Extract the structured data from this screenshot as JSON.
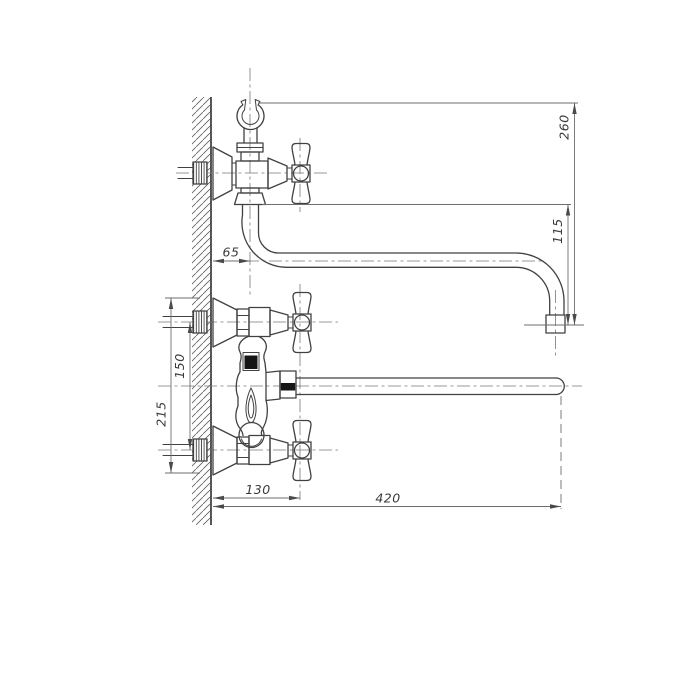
{
  "drawing": {
    "subject": "wall-mounted bathtub mixer faucet, side view technical drawing",
    "background_color": "#ffffff",
    "line_color": "#414141",
    "thin_line_color": "#6e6e6e",
    "dimensions": {
      "wall_to_spout_axis": "65",
      "wall_to_handle_axis": "130",
      "spout_reach": "420",
      "inlet_spacing": "150",
      "overall_height": "215",
      "spout_drop": "115",
      "shower_outlet_height": "260"
    }
  }
}
